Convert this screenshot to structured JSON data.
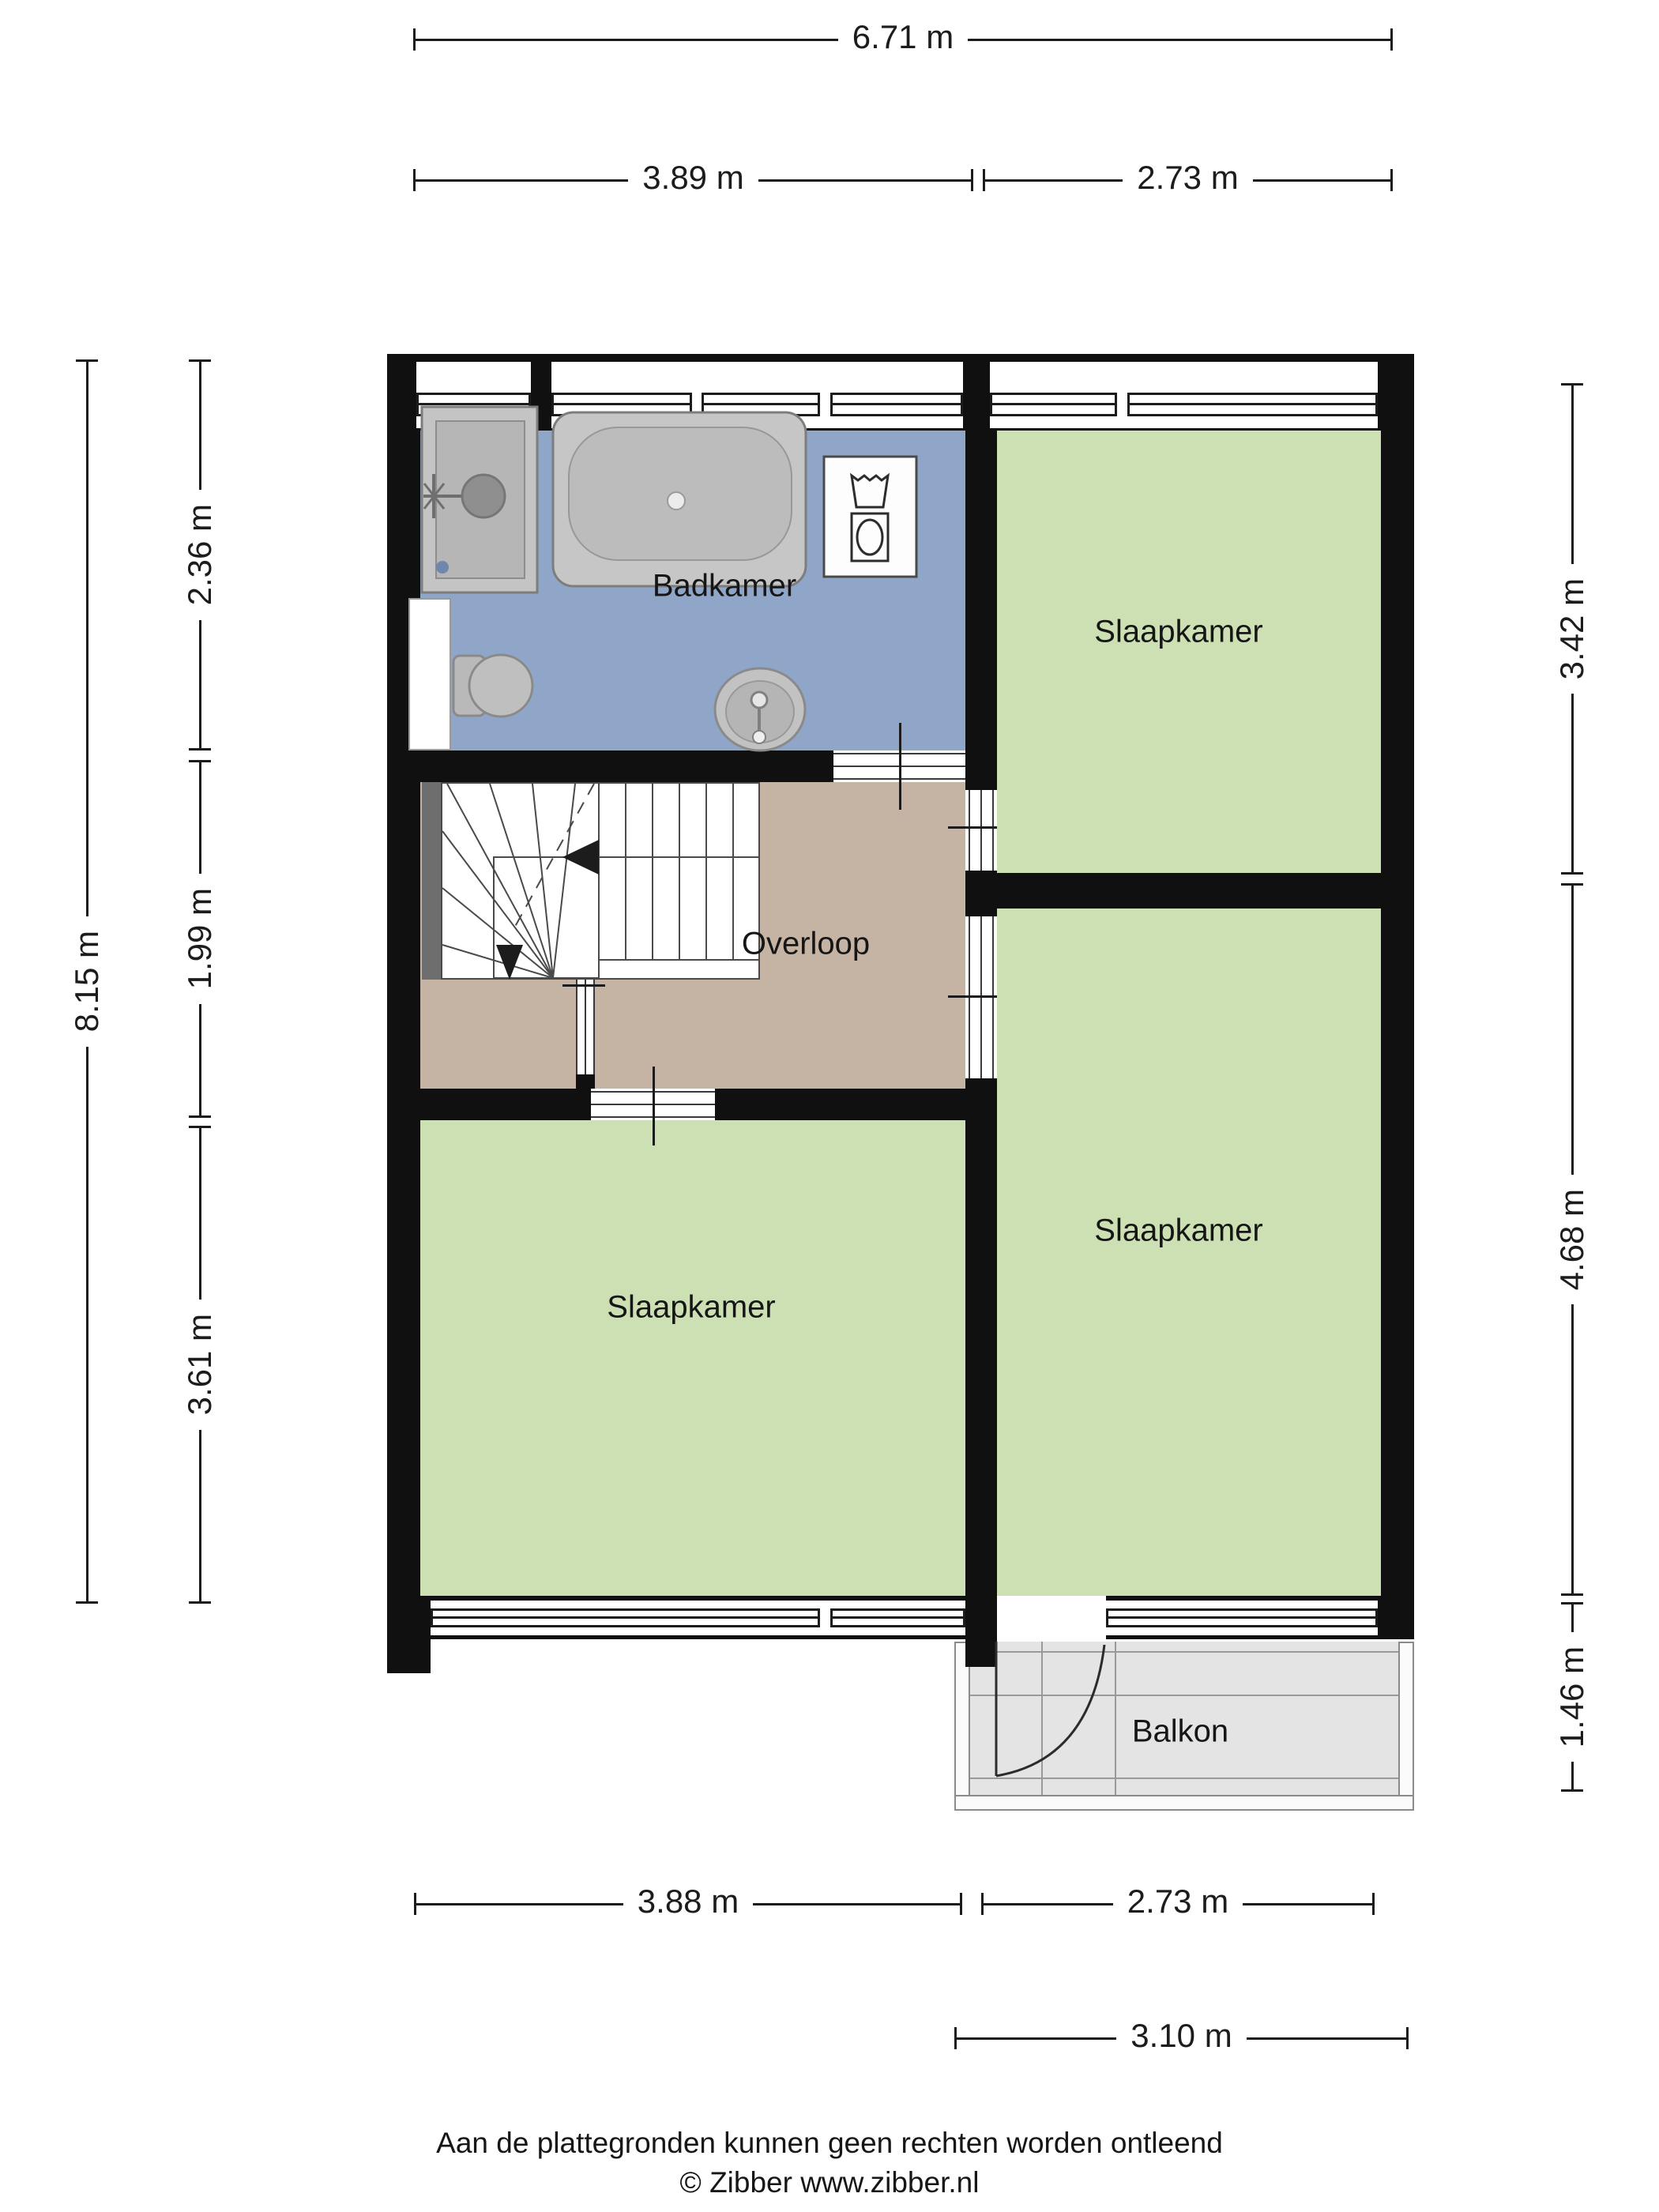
{
  "labels": {
    "badkamer": "Badkamer",
    "slaapkamer": "Slaapkamer",
    "overloop": "Overloop",
    "balkon": "Balkon"
  },
  "dims": {
    "top_total": "6.71 m",
    "top_a": "3.89 m",
    "top_b": "2.73 m",
    "left_total": "8.15 m",
    "left_a": "2.36 m",
    "left_b": "1.99 m",
    "left_c": "3.61 m",
    "right_a": "3.42 m",
    "right_b": "4.68 m",
    "right_c": "1.46 m",
    "bottom_a": "3.88 m",
    "bottom_b": "2.73 m",
    "bottom_c": "3.10 m"
  },
  "footer": {
    "line1": "Aan de plattegronden kunnen geen rechten worden ontleend",
    "line2": "© Zibber www.zibber.nl"
  },
  "colors": {
    "wall": "#101010",
    "bathroom_floor": "#90a6c8",
    "bedroom_floor": "#cde0b3",
    "hall_floor": "#c5b4a4",
    "balcony_floor": "#e4e4e4",
    "ink": "#1c1c1c"
  }
}
